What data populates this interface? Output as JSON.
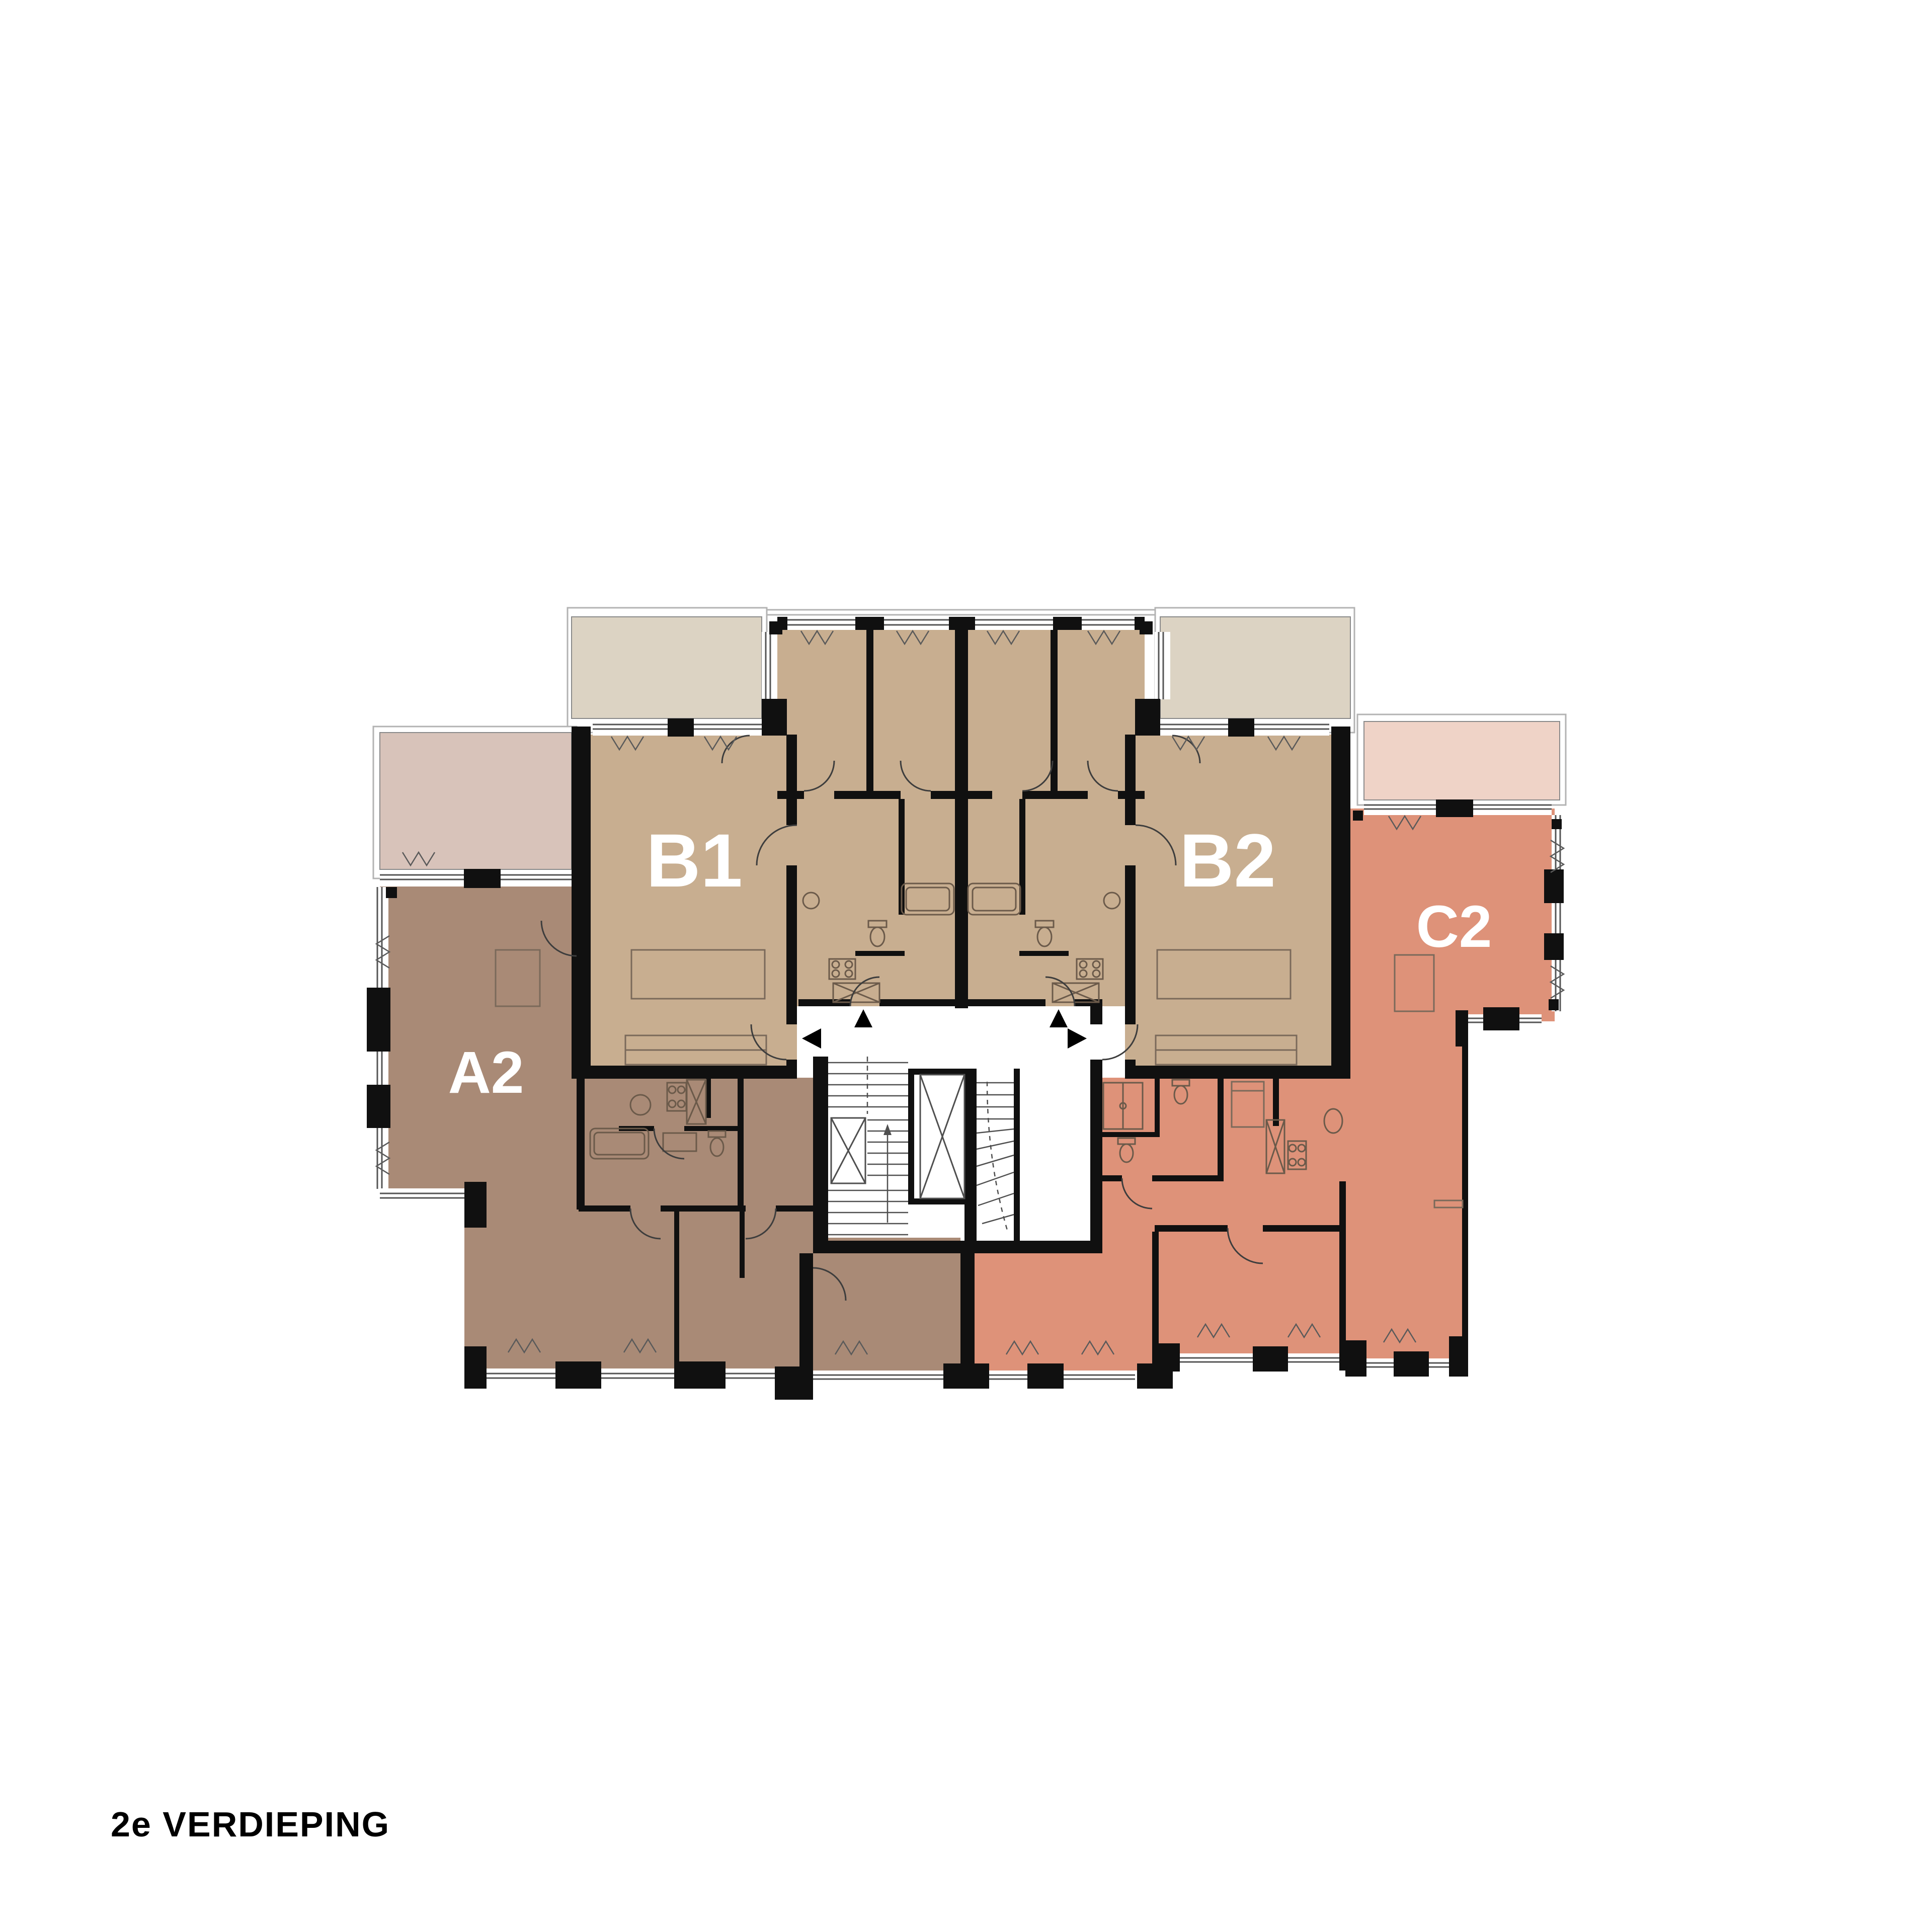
{
  "title": "2e VERDIEPING",
  "plan": {
    "type": "apartment-floor-plan",
    "floor": "2e verdieping (2nd floor)",
    "units": [
      {
        "id": "A2",
        "label": "A2",
        "color": "#a98a76",
        "terrace_color": "#d8c3ba",
        "position": "left"
      },
      {
        "id": "B1",
        "label": "B1",
        "color": "#c8ae90",
        "terrace_color": "#dcd3c3",
        "position": "center-left"
      },
      {
        "id": "B2",
        "label": "B2",
        "color": "#c8ae90",
        "terrace_color": "#dcd3c3",
        "position": "center-right"
      },
      {
        "id": "C2",
        "label": "C2",
        "color": "#de9279",
        "terrace_color": "#efd3c7",
        "position": "right"
      }
    ],
    "core": {
      "elements": [
        "corridor",
        "staircase",
        "elevator",
        "winder-staircase",
        "vestibule"
      ],
      "entrance_arrow_count": 4,
      "entrance_arrow_color": "#000000"
    },
    "colors": {
      "background": "#ffffff",
      "wall": "#101010",
      "window_line": "#555555",
      "terrace_frame": "#b3b3b3",
      "furniture_line": "#6b5a4a",
      "label_text": "#ffffff",
      "title_text": "#000000"
    }
  }
}
